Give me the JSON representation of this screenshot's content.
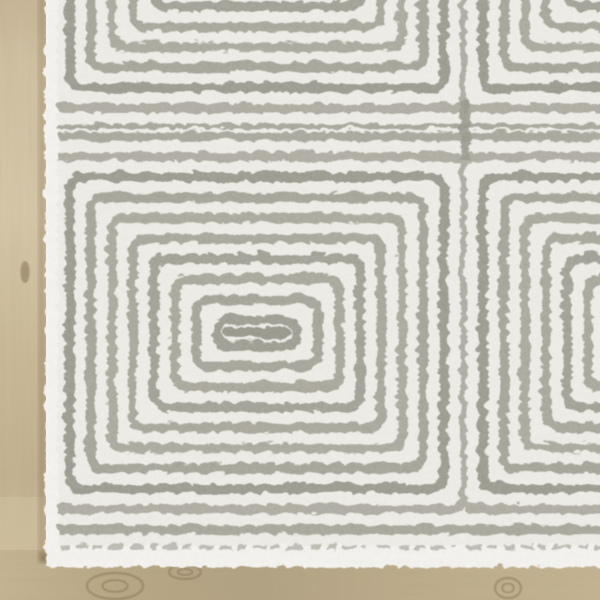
{
  "scene": {
    "type": "product-photo",
    "alt": "Corner of an ivory and grey area rug with a concentric-squares maze pattern, lying on a light oak wood plank floor",
    "canvas": {
      "width": 600,
      "height": 600
    }
  },
  "palette": {
    "rug_background": "#f0eee8",
    "rug_binding": "#f8f7f3",
    "rug_line": "#8a8a7d",
    "rug_line_light": "#9a998c",
    "wood_left_a": "#cdbd9e",
    "wood_left_b": "#d8c9ab",
    "wood_left_c": "#c3b292",
    "wood_bottom_light": "#c4b393",
    "wood_bottom_mid": "#b2a284",
    "wood_seam": "#88775a",
    "wood_knot": "#7d6c4e",
    "shadow": "#5f5138"
  },
  "rug": {
    "edge": {
      "left_wood_end": 44,
      "binding_inner": 56,
      "pattern_bottom": 535,
      "binding_bottom": 557
    },
    "pattern": {
      "ring_count": 12,
      "pitch_x": 21,
      "pitch_y": 20.4,
      "half_width_base": 19,
      "half_height_base": -7.4,
      "stroke_width": 9.5,
      "corner_radius": 12,
      "dash": {
        "width": 68,
        "height": 11,
        "radius": 5.5
      },
      "tiles": [
        {
          "cx": 255,
          "cy": -70,
          "clip": [
            56,
            -90,
            407,
            217
          ]
        },
        {
          "cx": 668,
          "cy": -70,
          "clip": [
            463,
            -90,
            153,
            217
          ]
        },
        {
          "cx": 255,
          "cy": 331,
          "clip": [
            56,
            127,
            407,
            408
          ]
        },
        {
          "cx": 668,
          "cy": 331,
          "clip": [
            463,
            127,
            153,
            408
          ]
        }
      ],
      "junction_connectors": [
        {
          "x": 463,
          "y1": 100,
          "y2": 158
        }
      ]
    },
    "binding_speckle": {
      "y": 545,
      "x1": 58,
      "x2": 600,
      "width": 4.5,
      "dash": "9 6 14 5 7 8 16 7 11 6",
      "opacity": 0.55
    }
  },
  "floor": {
    "top_y": 557,
    "left_plank": {
      "x": 0,
      "width": 44,
      "seam_y": 497,
      "knot": {
        "cx": 25,
        "cy": 272,
        "rx": 4.5,
        "ry": 11
      }
    },
    "bottom_seams": [
      {
        "x": 245,
        "opacity": 0.65,
        "width": 2
      },
      {
        "x": 398,
        "opacity": 0.55,
        "width": 2
      },
      {
        "x": 573,
        "opacity": 0.3,
        "width": 1.5
      }
    ],
    "bottom_knots": [
      {
        "cx": 115,
        "cy": 586,
        "rx": 28,
        "ry": 13
      },
      {
        "cx": 185,
        "cy": 572,
        "rx": 16,
        "ry": 7
      },
      {
        "cx": 508,
        "cy": 588,
        "rx": 13,
        "ry": 10
      }
    ]
  }
}
